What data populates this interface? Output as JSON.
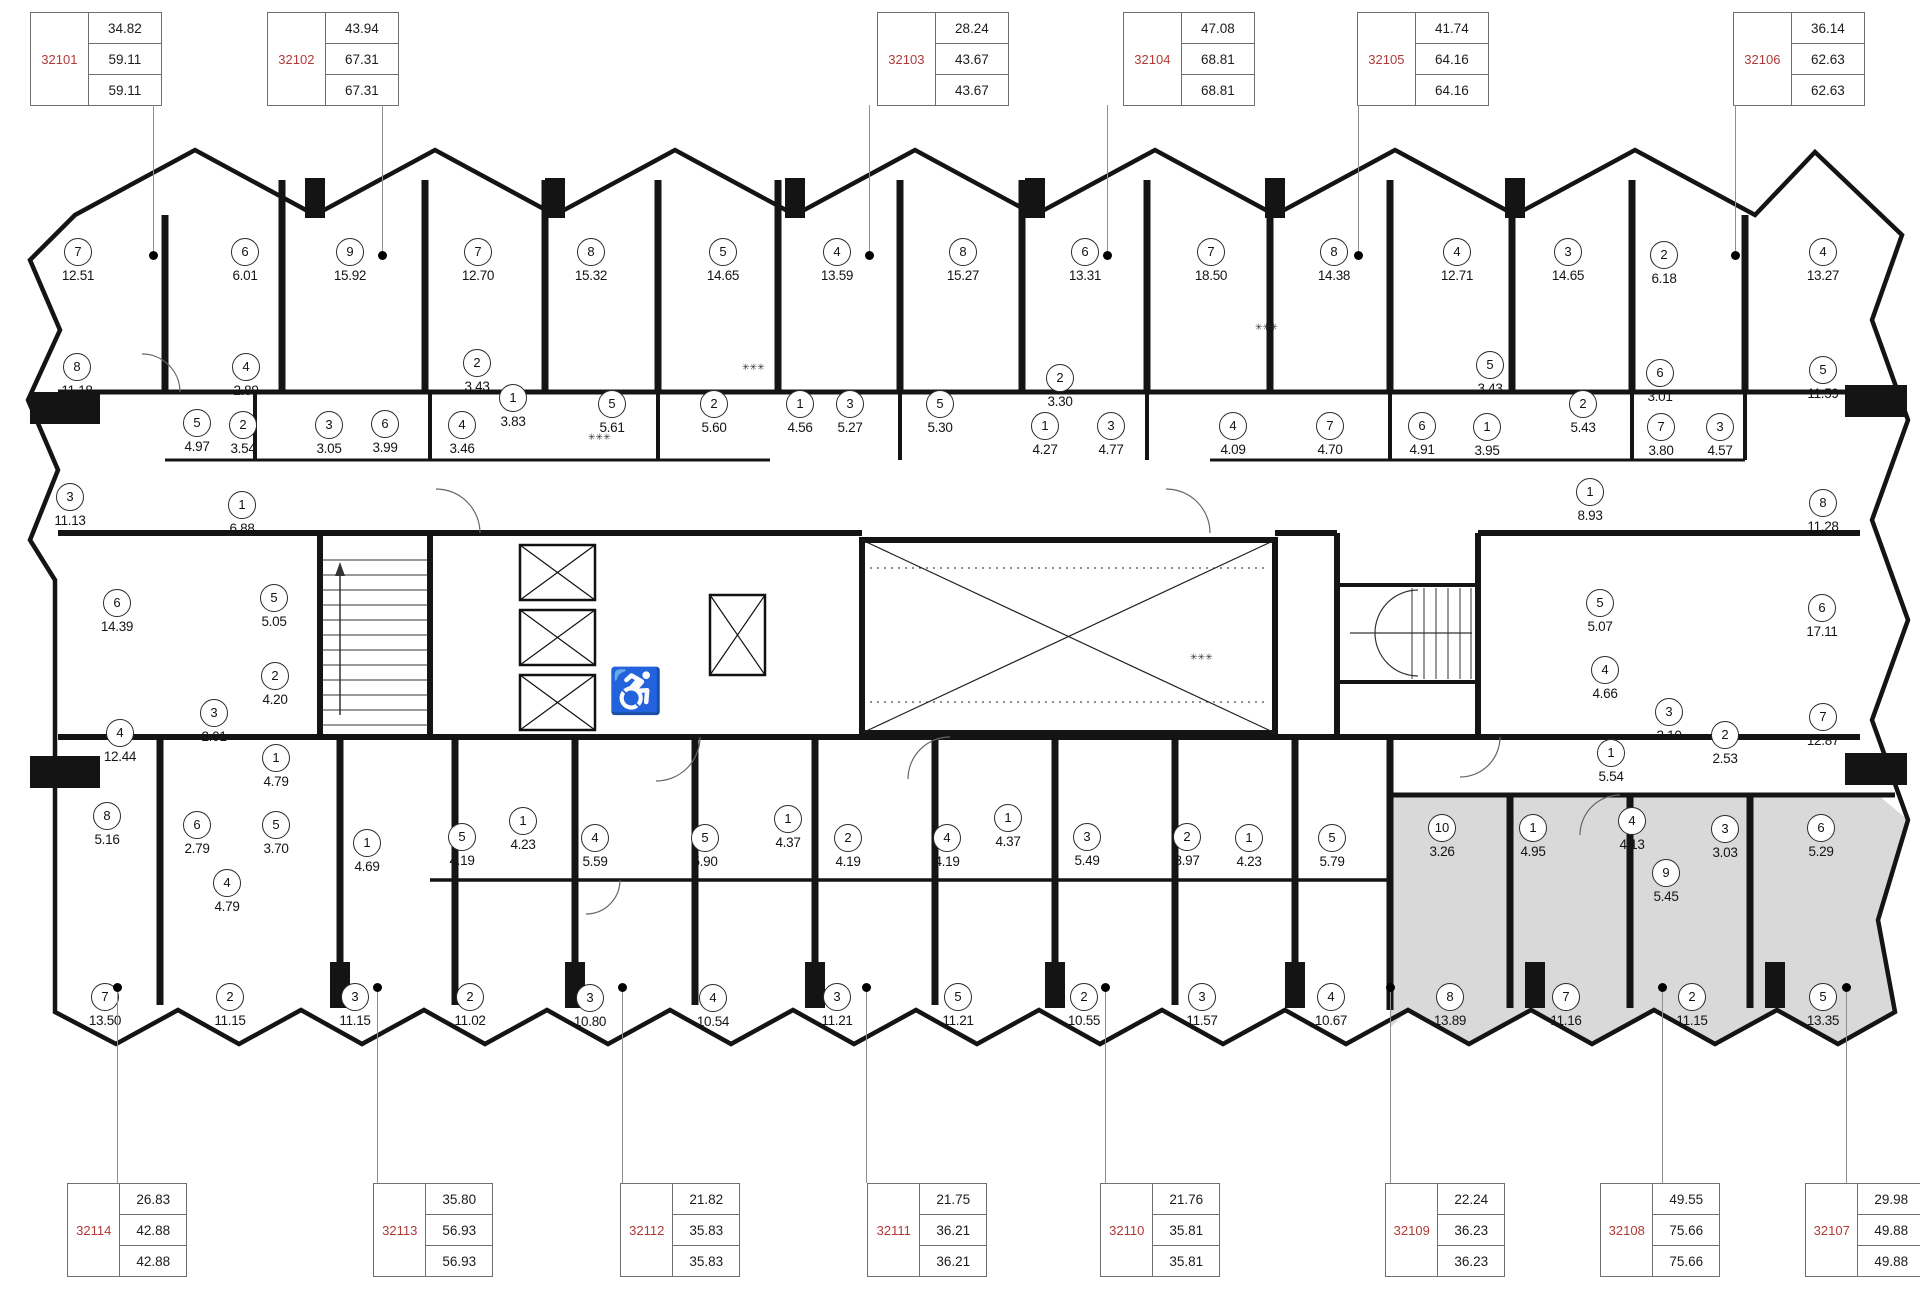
{
  "palette": {
    "wall": "#141414",
    "thin": "#555",
    "red": "#b03a36",
    "gray_fill": "#d9d9d9",
    "line": "#909090"
  },
  "icons": {
    "wheelchair": "♿",
    "vent": "✳✳✳"
  },
  "units_top": [
    {
      "id": "32101",
      "x": 30,
      "values": [
        "34.82",
        "59.11",
        "59.11"
      ]
    },
    {
      "id": "32102",
      "x": 267,
      "values": [
        "43.94",
        "67.31",
        "67.31"
      ]
    },
    {
      "id": "32103",
      "x": 877,
      "values": [
        "28.24",
        "43.67",
        "43.67"
      ]
    },
    {
      "id": "32104",
      "x": 1123,
      "values": [
        "47.08",
        "68.81",
        "68.81"
      ]
    },
    {
      "id": "32105",
      "x": 1357,
      "values": [
        "41.74",
        "64.16",
        "64.16"
      ]
    },
    {
      "id": "32106",
      "x": 1733,
      "values": [
        "36.14",
        "62.63",
        "62.63"
      ]
    }
  ],
  "units_bottom": [
    {
      "id": "32114",
      "x": 67,
      "values": [
        "26.83",
        "42.88",
        "42.88"
      ]
    },
    {
      "id": "32113",
      "x": 373,
      "values": [
        "35.80",
        "56.93",
        "56.93"
      ]
    },
    {
      "id": "32112",
      "x": 620,
      "values": [
        "21.82",
        "35.83",
        "35.83"
      ]
    },
    {
      "id": "32111",
      "x": 867,
      "values": [
        "21.75",
        "36.21",
        "36.21"
      ]
    },
    {
      "id": "32110",
      "x": 1100,
      "values": [
        "21.76",
        "35.81",
        "35.81"
      ]
    },
    {
      "id": "32109",
      "x": 1385,
      "values": [
        "22.24",
        "36.23",
        "36.23"
      ]
    },
    {
      "id": "32108",
      "x": 1600,
      "values": [
        "49.55",
        "75.66",
        "75.66"
      ]
    },
    {
      "id": "32107",
      "x": 1805,
      "values": [
        "29.98",
        "49.88",
        "49.88"
      ]
    }
  ],
  "leaders_top": [
    153,
    382,
    869,
    1107,
    1358,
    1735
  ],
  "leaders_bottom": [
    117,
    377,
    622,
    866,
    1105,
    1390,
    1662,
    1846
  ],
  "rooms": [
    {
      "n": "7",
      "a": "12.51",
      "x": 78,
      "y": 252
    },
    {
      "n": "6",
      "a": "6.01",
      "x": 245,
      "y": 252
    },
    {
      "n": "9",
      "a": "15.92",
      "x": 350,
      "y": 252
    },
    {
      "n": "7",
      "a": "12.70",
      "x": 478,
      "y": 252
    },
    {
      "n": "8",
      "a": "15.32",
      "x": 591,
      "y": 252
    },
    {
      "n": "5",
      "a": "14.65",
      "x": 723,
      "y": 252
    },
    {
      "n": "4",
      "a": "13.59",
      "x": 837,
      "y": 252
    },
    {
      "n": "8",
      "a": "15.27",
      "x": 963,
      "y": 252
    },
    {
      "n": "6",
      "a": "13.31",
      "x": 1085,
      "y": 252
    },
    {
      "n": "7",
      "a": "18.50",
      "x": 1211,
      "y": 252
    },
    {
      "n": "8",
      "a": "14.38",
      "x": 1334,
      "y": 252
    },
    {
      "n": "4",
      "a": "12.71",
      "x": 1457,
      "y": 252
    },
    {
      "n": "3",
      "a": "14.65",
      "x": 1568,
      "y": 252
    },
    {
      "n": "2",
      "a": "6.18",
      "x": 1664,
      "y": 255
    },
    {
      "n": "4",
      "a": "13.27",
      "x": 1823,
      "y": 252
    },
    {
      "n": "8",
      "a": "11.18",
      "x": 77,
      "y": 367
    },
    {
      "n": "4",
      "a": "2.89",
      "x": 246,
      "y": 367
    },
    {
      "n": "2",
      "a": "3.43",
      "x": 477,
      "y": 363
    },
    {
      "n": "5",
      "a": "4.97",
      "x": 197,
      "y": 423
    },
    {
      "n": "2",
      "a": "3.54",
      "x": 243,
      "y": 425
    },
    {
      "n": "3",
      "a": "3.05",
      "x": 329,
      "y": 425
    },
    {
      "n": "6",
      "a": "3.99",
      "x": 385,
      "y": 424
    },
    {
      "n": "4",
      "a": "3.46",
      "x": 462,
      "y": 425
    },
    {
      "n": "1",
      "a": "3.83",
      "x": 513,
      "y": 398
    },
    {
      "n": "5",
      "a": "5.61",
      "x": 612,
      "y": 404
    },
    {
      "n": "2",
      "a": "5.60",
      "x": 714,
      "y": 404
    },
    {
      "n": "1",
      "a": "4.56",
      "x": 800,
      "y": 404
    },
    {
      "n": "3",
      "a": "5.27",
      "x": 850,
      "y": 404
    },
    {
      "n": "5",
      "a": "5.30",
      "x": 940,
      "y": 404
    },
    {
      "n": "2",
      "a": "3.30",
      "x": 1060,
      "y": 378
    },
    {
      "n": "1",
      "a": "4.27",
      "x": 1045,
      "y": 426
    },
    {
      "n": "3",
      "a": "4.77",
      "x": 1111,
      "y": 426
    },
    {
      "n": "4",
      "a": "4.09",
      "x": 1233,
      "y": 426
    },
    {
      "n": "7",
      "a": "4.70",
      "x": 1330,
      "y": 426
    },
    {
      "n": "6",
      "a": "4.91",
      "x": 1422,
      "y": 426
    },
    {
      "n": "5",
      "a": "3.43",
      "x": 1490,
      "y": 365
    },
    {
      "n": "1",
      "a": "3.95",
      "x": 1487,
      "y": 427
    },
    {
      "n": "2",
      "a": "5.43",
      "x": 1583,
      "y": 404
    },
    {
      "n": "6",
      "a": "3.01",
      "x": 1660,
      "y": 373
    },
    {
      "n": "7",
      "a": "3.80",
      "x": 1661,
      "y": 427
    },
    {
      "n": "3",
      "a": "4.57",
      "x": 1720,
      "y": 427
    },
    {
      "n": "5",
      "a": "11.59",
      "x": 1823,
      "y": 370
    },
    {
      "n": "8",
      "a": "11.28",
      "x": 1823,
      "y": 503
    },
    {
      "n": "1",
      "a": "8.93",
      "x": 1590,
      "y": 492
    },
    {
      "n": "3",
      "a": "11.13",
      "x": 70,
      "y": 497
    },
    {
      "n": "1",
      "a": "6.88",
      "x": 242,
      "y": 505
    },
    {
      "n": "6",
      "a": "14.39",
      "x": 117,
      "y": 603
    },
    {
      "n": "5",
      "a": "5.05",
      "x": 274,
      "y": 598
    },
    {
      "n": "2",
      "a": "4.20",
      "x": 275,
      "y": 676
    },
    {
      "n": "3",
      "a": "2.01",
      "x": 214,
      "y": 713
    },
    {
      "n": "4",
      "a": "12.44",
      "x": 120,
      "y": 733
    },
    {
      "n": "1",
      "a": "4.79",
      "x": 276,
      "y": 758
    },
    {
      "n": "5",
      "a": "5.07",
      "x": 1600,
      "y": 603
    },
    {
      "n": "6",
      "a": "17.11",
      "x": 1822,
      "y": 608
    },
    {
      "n": "4",
      "a": "4.66",
      "x": 1605,
      "y": 670
    },
    {
      "n": "3",
      "a": "2.10",
      "x": 1669,
      "y": 712
    },
    {
      "n": "2",
      "a": "2.53",
      "x": 1725,
      "y": 735
    },
    {
      "n": "1",
      "a": "5.54",
      "x": 1611,
      "y": 753
    },
    {
      "n": "7",
      "a": "12.87",
      "x": 1823,
      "y": 717
    },
    {
      "n": "8",
      "a": "5.16",
      "x": 107,
      "y": 816
    },
    {
      "n": "6",
      "a": "2.79",
      "x": 197,
      "y": 825
    },
    {
      "n": "5",
      "a": "3.70",
      "x": 276,
      "y": 825
    },
    {
      "n": "1",
      "a": "4.69",
      "x": 367,
      "y": 843
    },
    {
      "n": "4",
      "a": "4.79",
      "x": 227,
      "y": 883
    },
    {
      "n": "5",
      "a": "4.19",
      "x": 462,
      "y": 837
    },
    {
      "n": "1",
      "a": "4.23",
      "x": 523,
      "y": 821
    },
    {
      "n": "4",
      "a": "5.59",
      "x": 595,
      "y": 838
    },
    {
      "n": "5",
      "a": "5.90",
      "x": 705,
      "y": 838
    },
    {
      "n": "1",
      "a": "4.37",
      "x": 788,
      "y": 819
    },
    {
      "n": "2",
      "a": "4.19",
      "x": 848,
      "y": 838
    },
    {
      "n": "4",
      "a": "4.19",
      "x": 947,
      "y": 838
    },
    {
      "n": "1",
      "a": "4.37",
      "x": 1008,
      "y": 818
    },
    {
      "n": "3",
      "a": "5.49",
      "x": 1087,
      "y": 837
    },
    {
      "n": "2",
      "a": "3.97",
      "x": 1187,
      "y": 837
    },
    {
      "n": "1",
      "a": "4.23",
      "x": 1249,
      "y": 838
    },
    {
      "n": "5",
      "a": "5.79",
      "x": 1332,
      "y": 838
    },
    {
      "n": "10",
      "a": "3.26",
      "x": 1442,
      "y": 828
    },
    {
      "n": "1",
      "a": "4.95",
      "x": 1533,
      "y": 828
    },
    {
      "n": "4",
      "a": "4.13",
      "x": 1632,
      "y": 821
    },
    {
      "n": "3",
      "a": "3.03",
      "x": 1725,
      "y": 829
    },
    {
      "n": "6",
      "a": "5.29",
      "x": 1821,
      "y": 828
    },
    {
      "n": "9",
      "a": "5.45",
      "x": 1666,
      "y": 873
    },
    {
      "n": "7",
      "a": "13.50",
      "x": 105,
      "y": 997
    },
    {
      "n": "2",
      "a": "11.15",
      "x": 230,
      "y": 997
    },
    {
      "n": "3",
      "a": "11.15",
      "x": 355,
      "y": 997
    },
    {
      "n": "2",
      "a": "11.02",
      "x": 470,
      "y": 997
    },
    {
      "n": "3",
      "a": "10.80",
      "x": 590,
      "y": 998
    },
    {
      "n": "4",
      "a": "10.54",
      "x": 713,
      "y": 998
    },
    {
      "n": "3",
      "a": "11.21",
      "x": 837,
      "y": 997
    },
    {
      "n": "5",
      "a": "11.21",
      "x": 958,
      "y": 997
    },
    {
      "n": "2",
      "a": "10.55",
      "x": 1084,
      "y": 997
    },
    {
      "n": "3",
      "a": "11.57",
      "x": 1202,
      "y": 997
    },
    {
      "n": "4",
      "a": "10.67",
      "x": 1331,
      "y": 997
    },
    {
      "n": "8",
      "a": "13.89",
      "x": 1450,
      "y": 997
    },
    {
      "n": "7",
      "a": "11.16",
      "x": 1566,
      "y": 997
    },
    {
      "n": "2",
      "a": "11.15",
      "x": 1692,
      "y": 997
    },
    {
      "n": "5",
      "a": "13.35",
      "x": 1823,
      "y": 997
    }
  ]
}
